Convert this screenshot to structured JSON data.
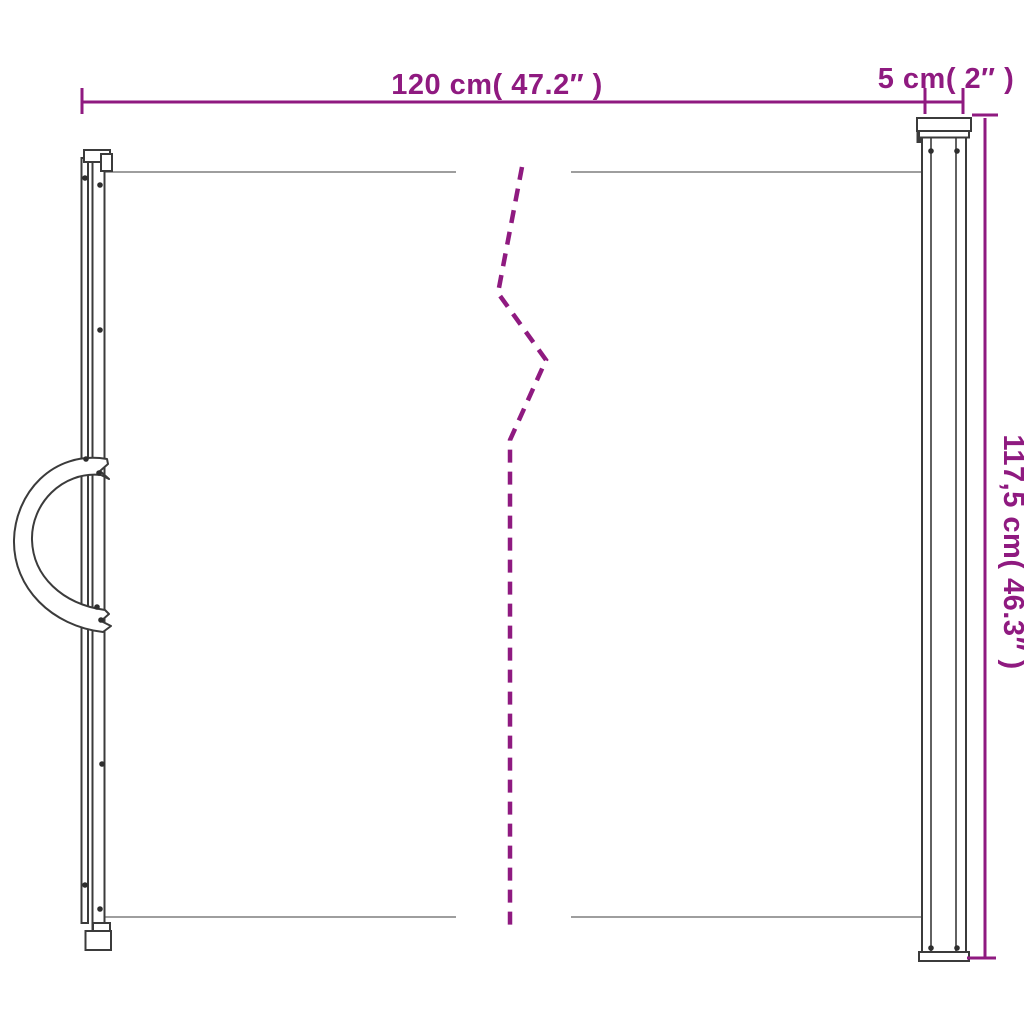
{
  "diagram": {
    "kind": "product-dimension-line-drawing",
    "subject": "retractable-gate-front-view",
    "labels": {
      "width": "120 cm( 47.2″ )",
      "cassette_width": "5 cm( 2″ )",
      "height": "117,5 cm( 46.3″ )"
    },
    "values": {
      "width_cm": 120,
      "width_inch": 47.2,
      "cassette_width_cm": 5,
      "cassette_width_inch": 2,
      "height_cm": 117.5,
      "height_inch": 46.3
    },
    "colors": {
      "dimension": "#8f1a80",
      "outline": "#3b3b3b",
      "screw": "#2e2e2e",
      "mesh_edge": "#7f7f7f",
      "background": "#ffffff"
    }
  }
}
